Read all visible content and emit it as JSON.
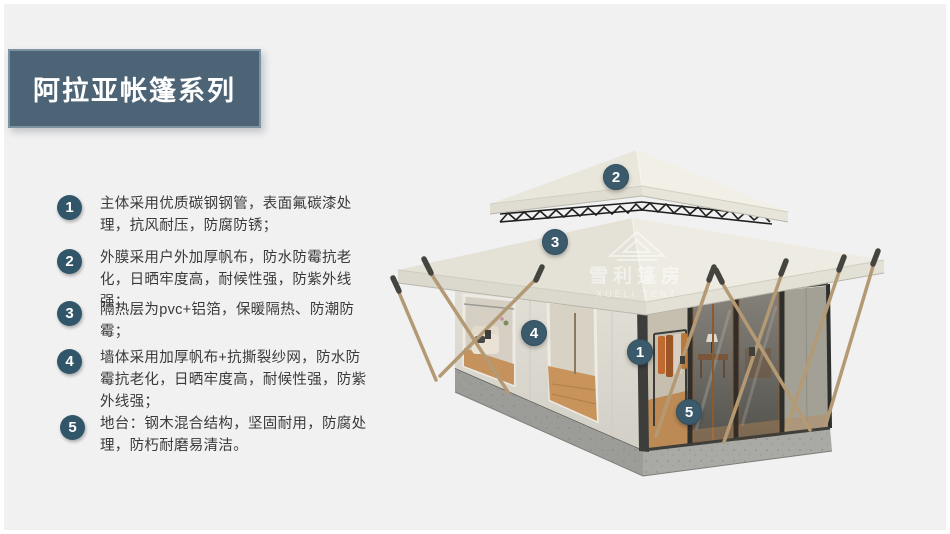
{
  "title": {
    "text": "阿拉亚帐篷系列"
  },
  "features": [
    {
      "num": "1",
      "text": "主体采用优质碳钢钢管，表面氟碳漆处理，抗风耐压，防腐防锈；"
    },
    {
      "num": "2",
      "text": "外膜采用户外加厚帆布，防水防霉抗老化，日晒牢度高，耐候性强，防紫外线强；"
    },
    {
      "num": "3",
      "text": "隔热层为pvc+铝箔，保暖隔热、防潮防霉；"
    },
    {
      "num": "4",
      "text": "墙体采用加厚帆布+抗撕裂纱网，防水防霉抗老化，日晒牢度高，耐候性强，防紫外线强；"
    },
    {
      "num": "5",
      "text": "地台：钢木混合结构，坚固耐用，防腐处理，防朽耐磨易清洁。"
    }
  ],
  "callouts": [
    {
      "label": "1"
    },
    {
      "label": "2"
    },
    {
      "label": "3"
    },
    {
      "label": "4"
    },
    {
      "label": "5"
    }
  ],
  "watermark": {
    "cn": "雪利篷房",
    "en": "XUELI TENT"
  },
  "colors": {
    "background": "#f1f1f2",
    "banner": "#4c6476",
    "accent_circle": "#3b5b6d",
    "roof_canvas": "#edeae1",
    "base_concrete": "#9c9c98"
  }
}
